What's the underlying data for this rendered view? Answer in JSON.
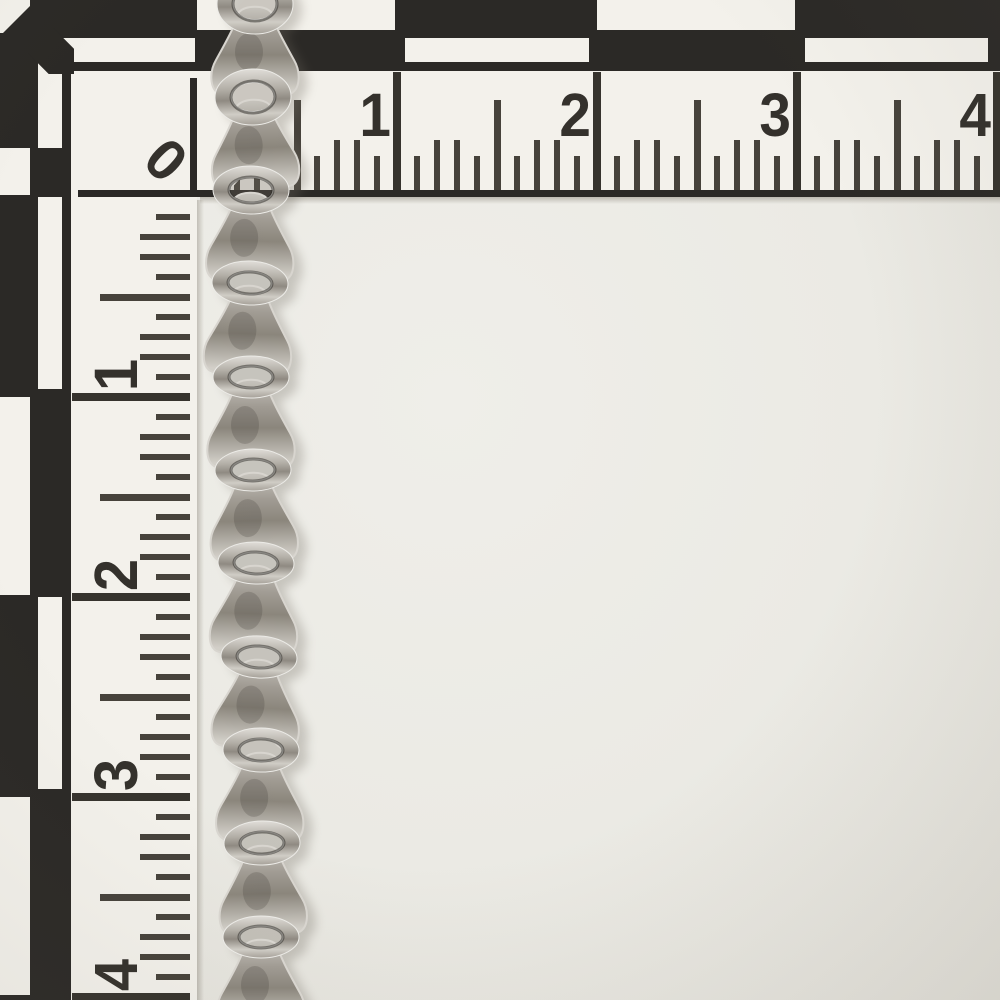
{
  "photo": {
    "subject": "antique silver fancy-link chain",
    "scene": "chain draped vertically over an L-shaped black-and-white photographic measuring scale card"
  },
  "scale": {
    "corner_label": "0",
    "horizontal_labels": [
      "1",
      "2",
      "3",
      "4"
    ],
    "vertical_labels": [
      "1",
      "2",
      "3",
      "4"
    ],
    "colors": {
      "scale_black": "#2b2926",
      "card_white": "#f3f1eb",
      "background": "#ebeae4",
      "tick": "#46423b",
      "metal_highlight": "#d6d3cc",
      "metal_mid": "#a8a39b",
      "metal_shadow": "#4f4b44"
    }
  }
}
